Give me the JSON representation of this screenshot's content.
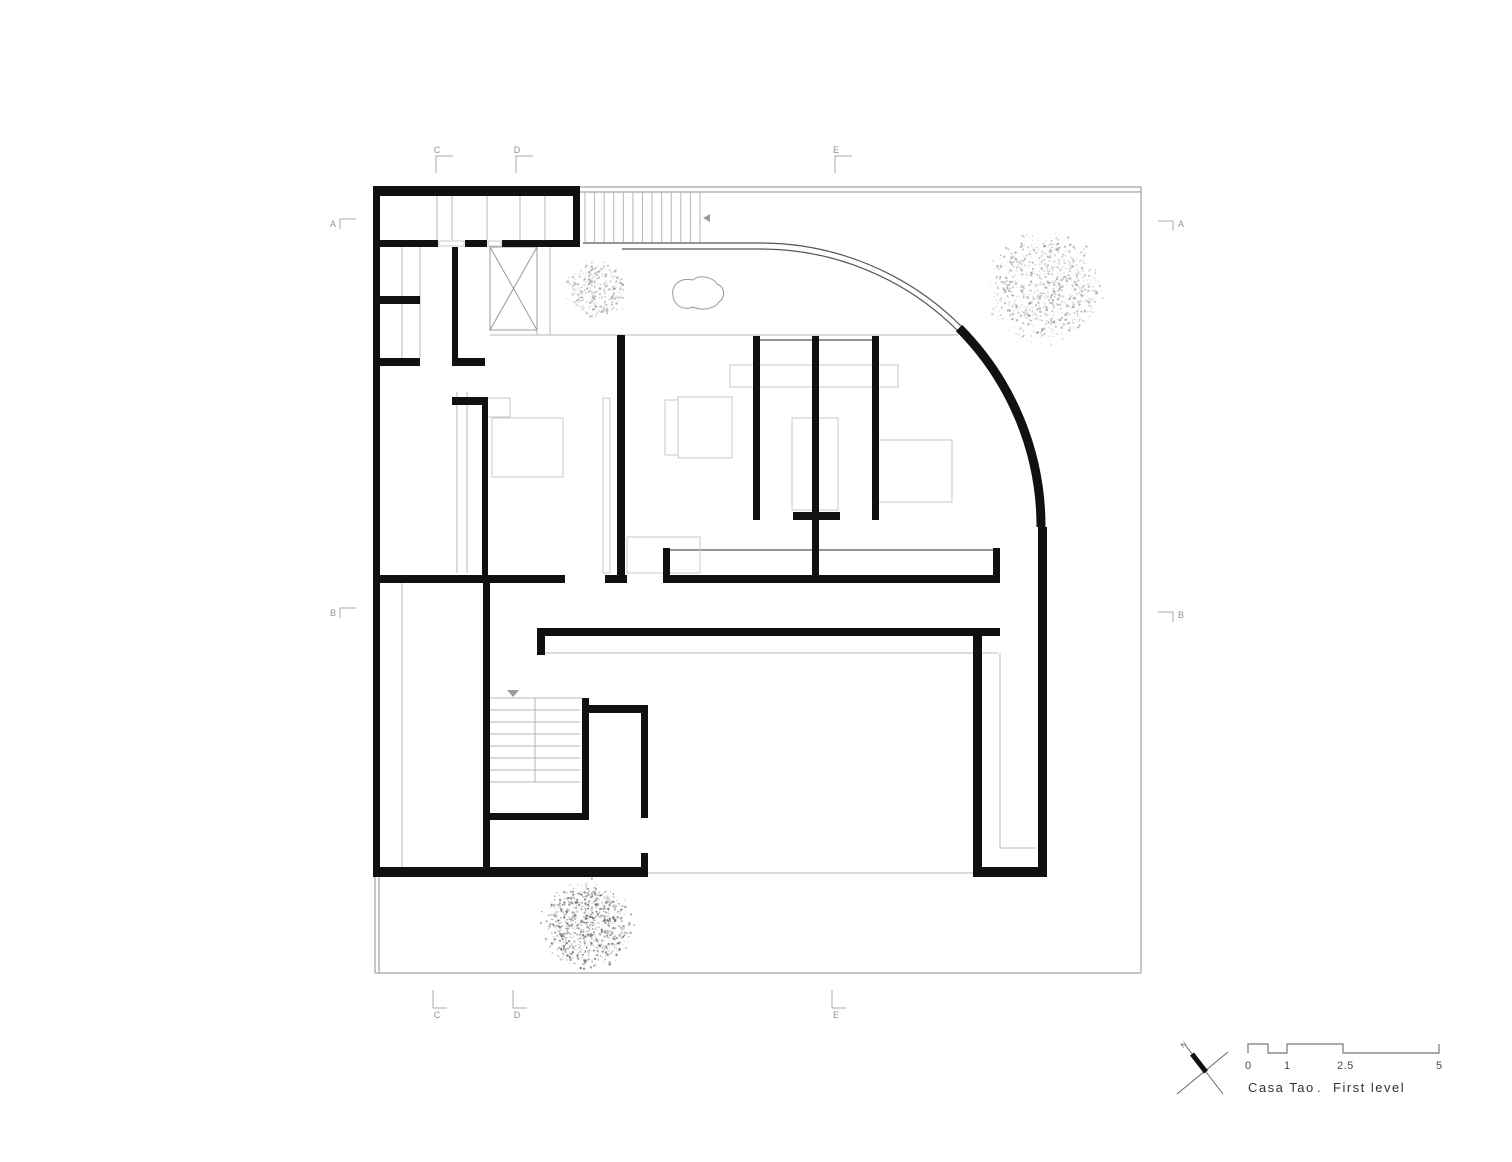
{
  "title_block": {
    "title_parts": {
      "project": "Casa Tao",
      "separator": ".",
      "level": "First level"
    },
    "north_label": "N",
    "scale_labels": [
      "0",
      "1",
      "2.5",
      "5"
    ]
  },
  "colors": {
    "background": "#ffffff",
    "wall": "#111111",
    "thin": "#8c8c8c",
    "glass": "#555555",
    "light": "#c9c9c9",
    "stair": "#b5b5b5",
    "text": "#4a4a4a",
    "marker": "#909090"
  },
  "grid_markers": [
    {
      "label": "A",
      "x": 333,
      "y": 224,
      "side": "left"
    },
    {
      "label": "B",
      "x": 333,
      "y": 613,
      "side": "left"
    },
    {
      "label": "A",
      "x": 1181,
      "y": 224,
      "side": "right"
    },
    {
      "label": "B",
      "x": 1181,
      "y": 615,
      "side": "right"
    },
    {
      "label": "C",
      "x": 437,
      "y": 150,
      "side": "top"
    },
    {
      "label": "D",
      "x": 517,
      "y": 150,
      "side": "top"
    },
    {
      "label": "E",
      "x": 836,
      "y": 150,
      "side": "top"
    },
    {
      "label": "C",
      "x": 437,
      "y": 1016,
      "side": "bottom"
    },
    {
      "label": "D",
      "x": 517,
      "y": 1016,
      "side": "bottom"
    },
    {
      "label": "E",
      "x": 836,
      "y": 1016,
      "side": "bottom"
    }
  ],
  "plan": {
    "walls": [
      [
        373,
        186,
        207,
        10
      ],
      [
        373,
        186,
        7,
        691
      ],
      [
        573,
        186,
        7,
        61
      ],
      [
        379,
        240,
        59,
        7
      ],
      [
        465,
        240,
        22,
        7
      ],
      [
        502,
        240,
        78,
        7
      ],
      [
        379,
        296,
        41,
        8
      ],
      [
        379,
        358,
        41,
        8
      ],
      [
        452,
        358,
        33,
        8
      ],
      [
        452,
        247,
        6,
        119
      ],
      [
        452,
        397,
        33,
        8
      ],
      [
        482,
        397,
        6,
        186
      ],
      [
        380,
        575,
        185,
        8
      ],
      [
        605,
        575,
        22,
        8
      ],
      [
        617,
        335,
        8,
        248
      ],
      [
        483,
        583,
        7,
        294
      ],
      [
        582,
        698,
        7,
        122
      ],
      [
        488,
        813,
        101,
        7
      ],
      [
        537,
        628,
        463,
        8
      ],
      [
        537,
        636,
        8,
        19
      ],
      [
        585,
        705,
        63,
        8
      ],
      [
        641,
        713,
        7,
        105
      ],
      [
        641,
        853,
        7,
        24
      ],
      [
        373,
        867,
        275,
        10
      ],
      [
        753,
        336,
        7,
        184
      ],
      [
        812,
        336,
        7,
        242
      ],
      [
        872,
        336,
        7,
        184
      ],
      [
        793,
        512,
        47,
        8
      ],
      [
        663,
        575,
        337,
        8
      ],
      [
        663,
        548,
        7,
        27
      ],
      [
        993,
        548,
        7,
        27
      ],
      [
        973,
        636,
        9,
        241
      ],
      [
        973,
        867,
        74,
        10
      ],
      [
        1038,
        527,
        9,
        350
      ]
    ],
    "thick_arc": {
      "d": "M 959 328 A 281 281 0 0 1 1041 527",
      "w": 9
    },
    "glass_arcs": [
      "M 760 243 A 284 284 0 0 1 961 326",
      "M 760 249 A 278 278 0 0 1 957 330"
    ],
    "site_lines": [
      [
        580,
        187,
        1141,
        187
      ],
      [
        580,
        192,
        1141,
        192
      ],
      [
        1141,
        187,
        1141,
        973
      ],
      [
        375,
        973,
        1141,
        973
      ],
      [
        375,
        877,
        375,
        973
      ],
      [
        379,
        877,
        379,
        973
      ]
    ],
    "glass_lines": [
      [
        583,
        243,
        760,
        243
      ],
      [
        622,
        249,
        760,
        249
      ],
      [
        753,
        340,
        878,
        340
      ],
      [
        670,
        550,
        993,
        550
      ]
    ],
    "detail_lines": [
      [
        490,
        335,
        958,
        335
      ],
      [
        545,
        653,
        998,
        653
      ],
      [
        648,
        873,
        973,
        873
      ],
      [
        1000,
        653,
        1000,
        848
      ],
      [
        1000,
        848,
        1036,
        848
      ],
      [
        437,
        196,
        437,
        240
      ],
      [
        452,
        196,
        452,
        240
      ],
      [
        487,
        196,
        487,
        240
      ],
      [
        520,
        196,
        520,
        240
      ],
      [
        545,
        196,
        545,
        240
      ],
      [
        537,
        247,
        537,
        335
      ],
      [
        550,
        247,
        550,
        335
      ],
      [
        420,
        247,
        420,
        358
      ],
      [
        402,
        247,
        402,
        366
      ],
      [
        402,
        583,
        402,
        867
      ],
      [
        457,
        392,
        457,
        573
      ],
      [
        467,
        392,
        467,
        573
      ],
      [
        488,
        698,
        582,
        698
      ]
    ],
    "shaft": {
      "x": 490,
      "y": 247,
      "w": 47,
      "h": 83
    },
    "furniture": [
      [
        492,
        418,
        71,
        59
      ],
      [
        485,
        398,
        25,
        19
      ],
      [
        730,
        365,
        168,
        22
      ],
      [
        665,
        400,
        13,
        55
      ],
      [
        678,
        397,
        54,
        61
      ],
      [
        878,
        440,
        74,
        62
      ],
      [
        792,
        418,
        46,
        92
      ],
      [
        603,
        398,
        7,
        175
      ],
      [
        627,
        537,
        73,
        36
      ],
      [
        439,
        241,
        25,
        5
      ],
      [
        488,
        241,
        13,
        5
      ]
    ],
    "stairs_top": {
      "x1": 585,
      "x2": 700,
      "y1": 192,
      "y2": 242,
      "count": 13,
      "arrow": [
        703,
        218,
        710,
        214,
        710,
        222
      ]
    },
    "stairs_bottom": {
      "x1": 488,
      "x2": 580,
      "y1": 698,
      "y2": 782,
      "rows": 7,
      "divider_x": 535,
      "arrow": [
        507,
        690,
        519,
        690,
        513,
        697
      ]
    },
    "rock_path": "M673,296 C671,285 680,277 693,280 C699,274 713,277 717,284 C725,287 726,297 719,302 C715,309 701,311 693,307 C683,311 674,305 673,296 Z",
    "trees": [
      {
        "cx": 597,
        "cy": 291,
        "r": 31,
        "n": 340,
        "shade": "#8a8a8a",
        "seed": 7
      },
      {
        "cx": 1045,
        "cy": 288,
        "r": 57,
        "n": 950,
        "shade": "#878787",
        "seed": 13
      },
      {
        "cx": 588,
        "cy": 925,
        "r": 45,
        "n": 900,
        "shade": "#4f4f4f",
        "seed": 29
      }
    ],
    "north_arrow": {
      "lines": [
        [
          1177,
          1094,
          1228,
          1052
        ],
        [
          1186,
          1046,
          1223,
          1094
        ]
      ],
      "needle": [
        1192,
        1054,
        1206,
        1072
      ],
      "label_x": 1183,
      "label_y": 1048
    },
    "scale_bar_path": "M1248,1053 L1248,1044 L1268,1044 L1268,1053 L1287,1053 L1287,1044 L1343,1044 L1343,1053 L1439,1053 L1439,1044",
    "scale_label_pos": [
      [
        1245,
        1069
      ],
      [
        1284,
        1069
      ],
      [
        1337,
        1069
      ],
      [
        1436,
        1069
      ]
    ]
  }
}
